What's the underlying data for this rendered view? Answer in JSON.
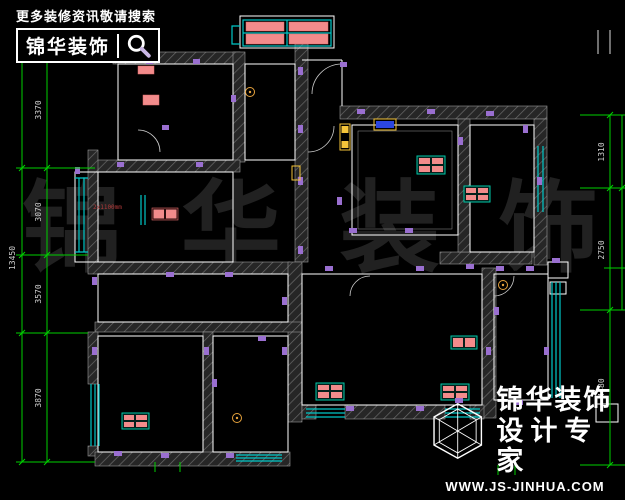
{
  "banner": {
    "tagline": "更多装修资讯敬请搜索",
    "brand": "锦华装饰",
    "icon": "magnifier-icon"
  },
  "footer": {
    "brand": "锦华装饰",
    "subtitle": "设计专家",
    "website": "WWW.JS-JINHUA.COM",
    "icon": "wireframe-cube-icon"
  },
  "watermark": {
    "text": "锦 华 装 饰"
  },
  "dimensions": {
    "left": {
      "d1": "3370",
      "d2": "3070",
      "d3": "3570",
      "d4": "3870",
      "overall": "13450"
    },
    "right": {
      "d1": "1310",
      "d2": "2750",
      "d3": "4480"
    }
  },
  "notes": {
    "radiator_note": "2x1100mm"
  },
  "colors": {
    "background": "#000000",
    "dimension_green": "#00d000",
    "dimension_text": "#cfcfcf",
    "window_cyan": "#00c8c8",
    "radiator_salmon": "#f28b8b",
    "radiator_teal": "#00c8a8",
    "socket_purple": "#9a6fd0",
    "door_yellow": "#f5c53a",
    "wall_edge_white": "#ffffff",
    "watermark_gray": "#212121"
  }
}
